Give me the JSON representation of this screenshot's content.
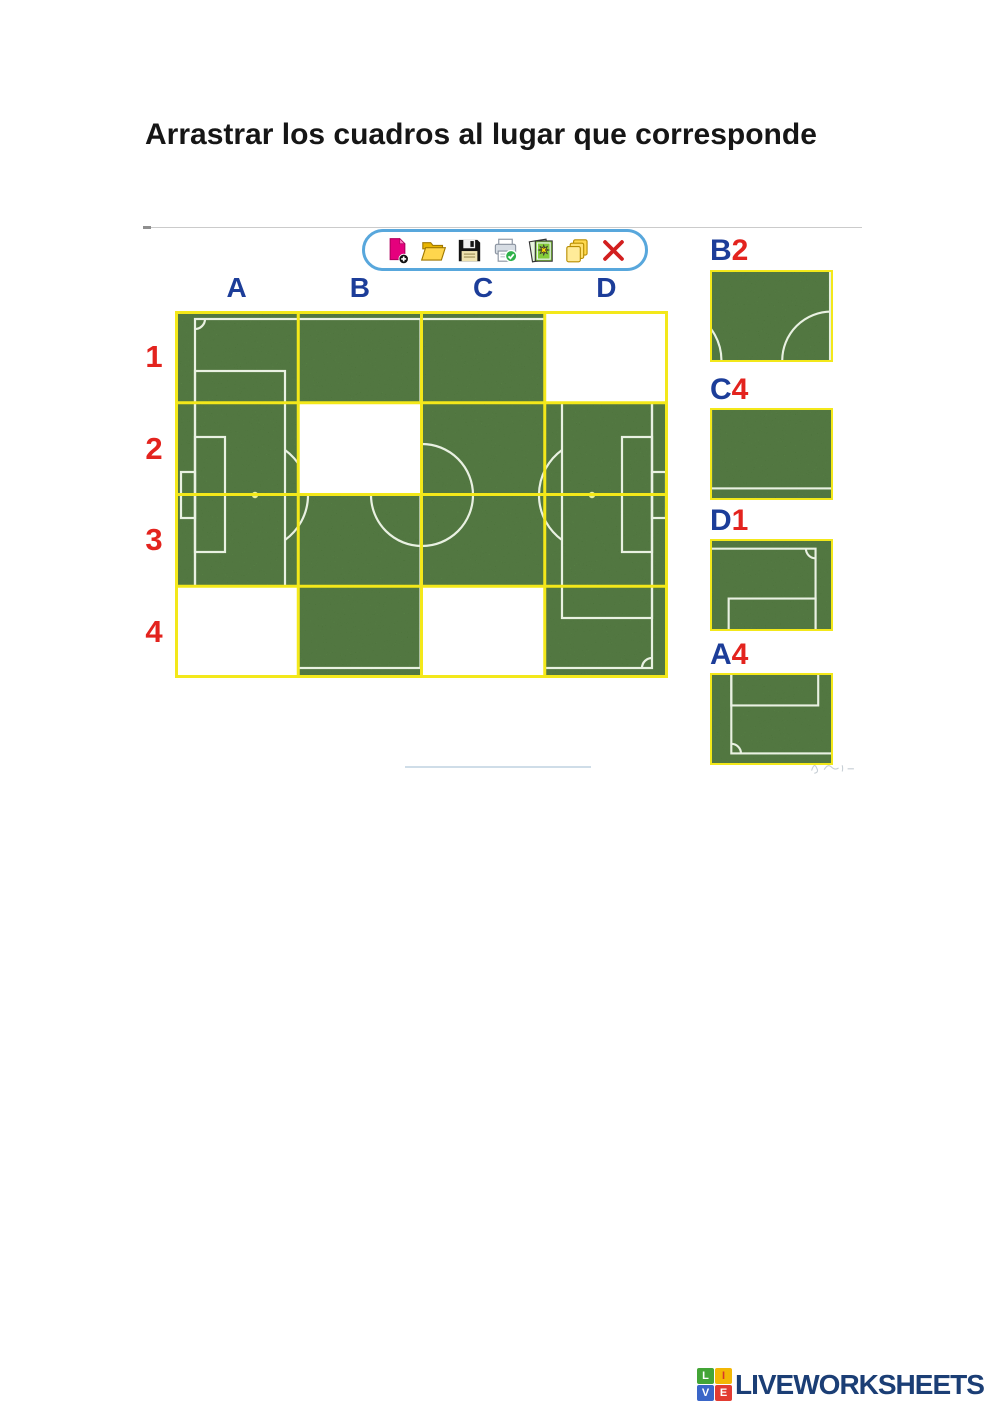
{
  "page": {
    "title": "Arrastrar los cuadros al lugar que corresponde"
  },
  "toolbar": {
    "icons": [
      "new-document",
      "open-folder",
      "save",
      "print",
      "image-gallery",
      "copy",
      "delete"
    ]
  },
  "board": {
    "columns": [
      "A",
      "B",
      "C",
      "D"
    ],
    "rows": [
      "1",
      "2",
      "3",
      "4"
    ],
    "missing_cells": [
      "D1",
      "B2",
      "A4",
      "C4"
    ],
    "image": "soccer-field-puzzle"
  },
  "pieces": [
    {
      "id": "B2",
      "letter": "B",
      "number": "2"
    },
    {
      "id": "C4",
      "letter": "C",
      "number": "4"
    },
    {
      "id": "D1",
      "letter": "D",
      "number": "1"
    },
    {
      "id": "A4",
      "letter": "A",
      "number": "4"
    }
  ],
  "footer": {
    "brand": "LIVEWORKSHEETS",
    "logo_letters": [
      "L",
      "I",
      "V",
      "E"
    ]
  },
  "theme": {
    "grass": "#4a8a2e",
    "pitch_line": "#e9f1e2",
    "grid_line": "#f3e81a",
    "col_label": "#1c3d99",
    "row_label": "#e3231e",
    "piece_letter": "#1c3d99",
    "piece_number": "#e3231e",
    "toolbar_border": "#58a7dc",
    "brand_navy": "#1b3e75",
    "logo_green": "#43a536",
    "logo_yellow": "#f2b705",
    "logo_blue": "#3a66c8",
    "logo_red": "#e23c32"
  }
}
